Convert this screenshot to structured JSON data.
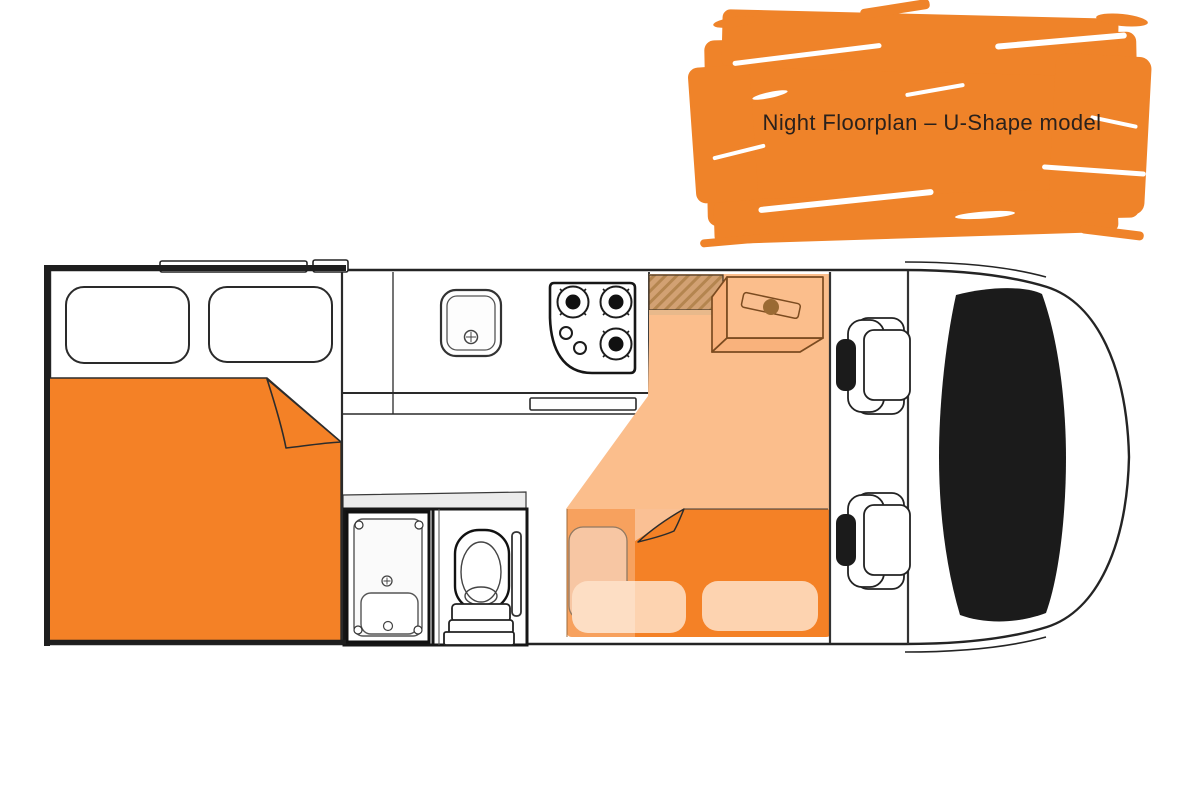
{
  "banner": {
    "title": "Night Floorplan – U-Shape model"
  },
  "floorplan": {
    "mode": "Night",
    "model": "U-Shape",
    "components": [
      "rear-double-bed",
      "rear-window-left",
      "rear-window-right",
      "roof-vent-long",
      "roof-vent-small",
      "kitchen-counter",
      "kitchen-drawer",
      "kitchen-sink",
      "stove-three-burners",
      "stove-knobs",
      "entry-step-wood",
      "overhead-cabinet",
      "walkway-floor",
      "dinette-converted-bed",
      "dinette-bench-cushion",
      "dinette-pillow-left",
      "dinette-pillow-right",
      "shower-cubicle",
      "toilet",
      "cab-seat-front",
      "cab-seat-rear",
      "windshield-black",
      "vehicle-body"
    ]
  },
  "colors": {
    "banner_orange": "#EF8329",
    "bed_orange": "#F48126",
    "floor_peach": "#FBBE8C",
    "cushion_pale": "#FDD3B0",
    "bench_peach": "#F5B384",
    "wood_tan": "#D2A173",
    "wood_stripe": "#B4854F",
    "cabinet_brown": "#7B4B20",
    "outline": "#242424",
    "gray_strip": "#EBEBEB",
    "text": "#2A211C",
    "bg": "#FFFFFF"
  }
}
